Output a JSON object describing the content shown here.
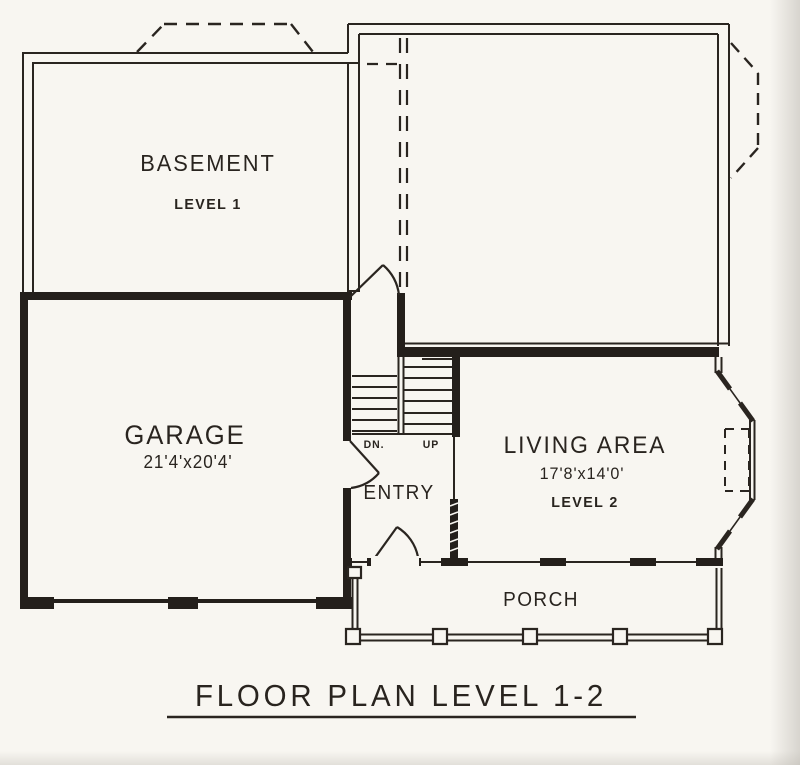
{
  "title": {
    "text": "FLOOR PLAN LEVEL 1-2"
  },
  "rooms": {
    "basement": {
      "name": "BASEMENT",
      "level": "LEVEL 1"
    },
    "garage": {
      "name": "GARAGE",
      "dimensions": "21'4'x20'4'"
    },
    "living_area": {
      "name": "LIVING AREA",
      "dimensions": "17'8'x14'0'",
      "level": "LEVEL 2"
    },
    "entry": {
      "name": "ENTRY"
    },
    "porch": {
      "name": "PORCH"
    }
  },
  "stairs": {
    "down": "DN.",
    "up": "UP"
  },
  "colors": {
    "ink": "#29241f",
    "paper": "#f8f6f1"
  }
}
